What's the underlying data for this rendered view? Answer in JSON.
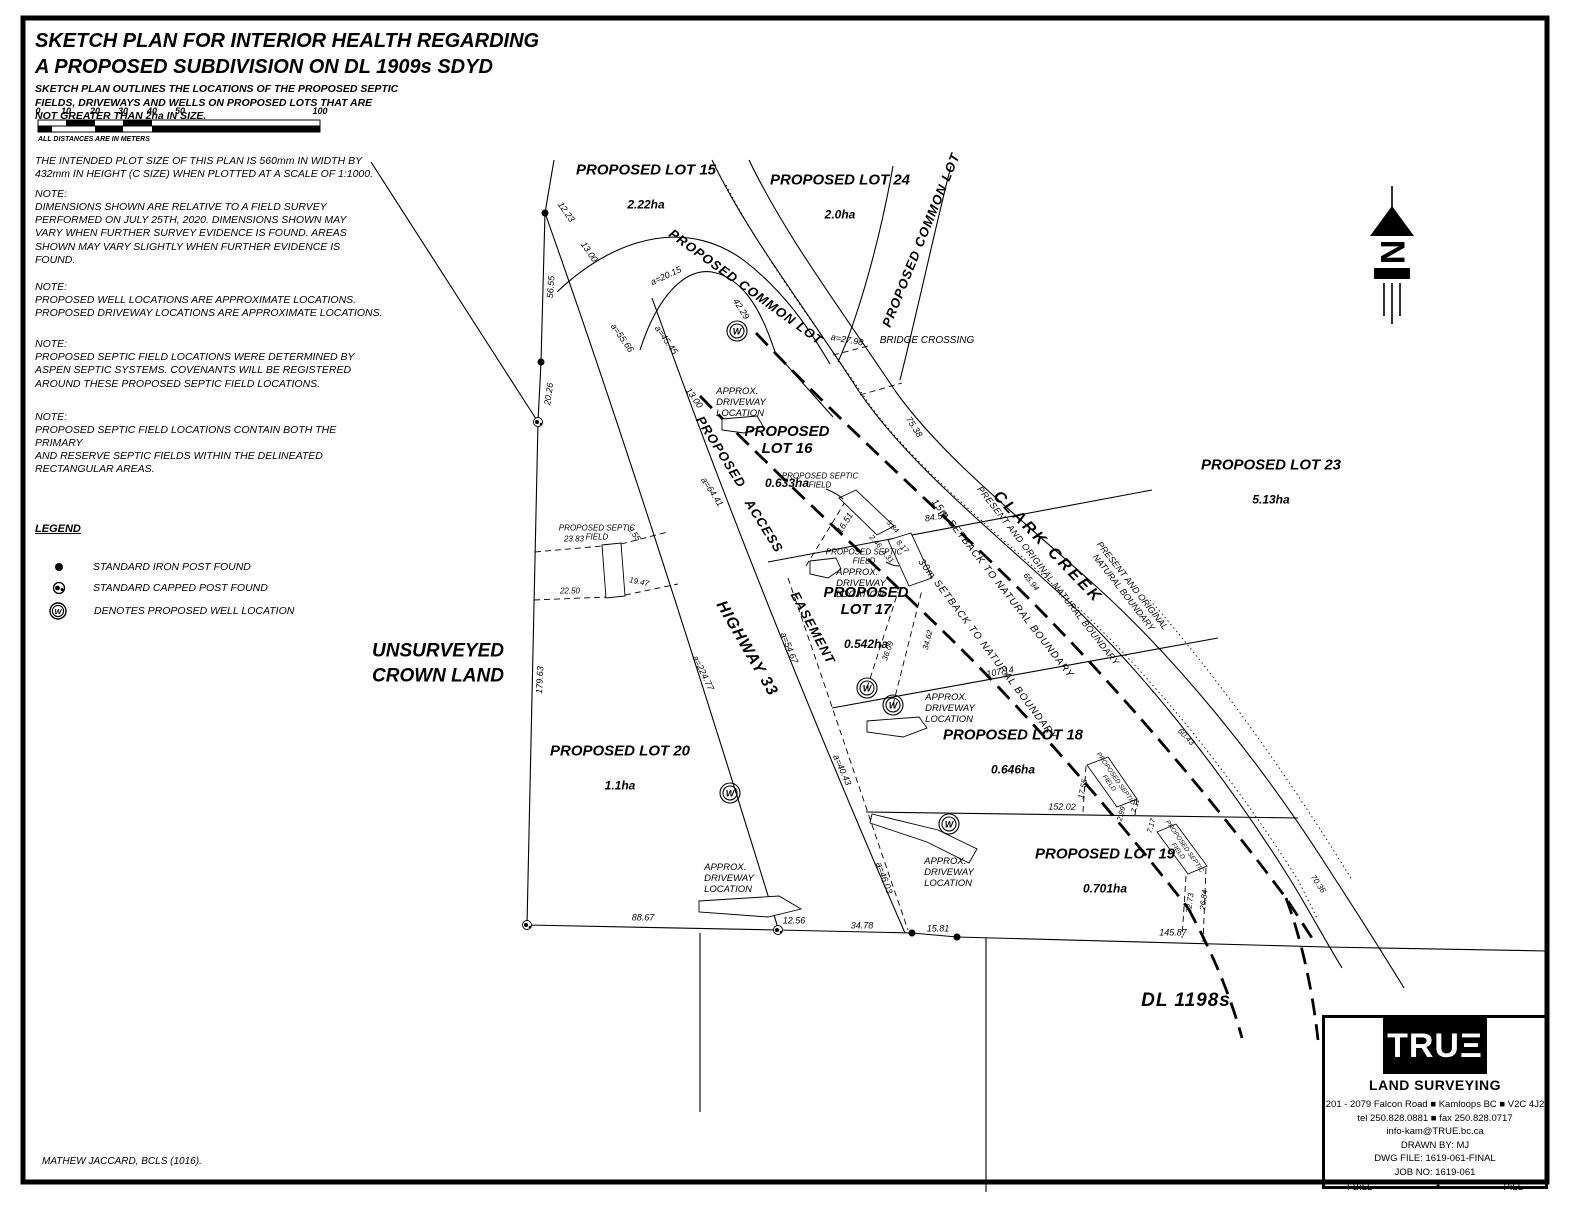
{
  "header": {
    "title1": "SKETCH PLAN FOR INTERIOR HEALTH REGARDING",
    "title2": "A PROPOSED SUBDIVISION ON DL 1909s SDYD",
    "subtitle": "SKETCH PLAN OUTLINES THE LOCATIONS OF THE PROPOSED SEPTIC\nFIELDS, DRIVEWAYS AND WELLS ON PROPOSED LOTS THAT ARE\nNOT GREATER THAN 2ha IN SIZE.",
    "plot_note": "THE INTENDED PLOT SIZE OF THIS PLAN IS 560mm IN WIDTH BY\n432mm IN HEIGHT (C SIZE) WHEN PLOTTED AT A SCALE OF 1:1000."
  },
  "scale_bar": {
    "ticks": [
      "0",
      "10",
      "20",
      "30",
      "40",
      "50",
      "100"
    ],
    "caption": "ALL DISTANCES ARE IN METERS"
  },
  "notes": [
    {
      "heading": "NOTE:",
      "body": "DIMENSIONS SHOWN ARE RELATIVE TO A FIELD SURVEY\nPERFORMED ON JULY 25TH, 2020. DIMENSIONS SHOWN MAY\nVARY WHEN FURTHER SURVEY EVIDENCE IS FOUND. AREAS\nSHOWN MAY VARY SLIGHTLY WHEN FURTHER EVIDENCE IS\nFOUND."
    },
    {
      "heading": "NOTE:",
      "body": "PROPOSED WELL LOCATIONS ARE APPROXIMATE LOCATIONS.\nPROPOSED DRIVEWAY LOCATIONS ARE APPROXIMATE LOCATIONS."
    },
    {
      "heading": "NOTE:",
      "body": "PROPOSED SEPTIC FIELD LOCATIONS WERE DETERMINED BY\nASPEN SEPTIC SYSTEMS. COVENANTS WILL BE REGISTERED\nAROUND THESE PROPOSED SEPTIC FIELD LOCATIONS."
    },
    {
      "heading": "NOTE:",
      "body": "PROPOSED SEPTIC FIELD LOCATIONS CONTAIN BOTH THE PRIMARY\nAND RESERVE SEPTIC FIELDS WITHIN THE DELINEATED\nRECTANGULAR AREAS."
    }
  ],
  "legend": {
    "title": "LEGEND",
    "items": [
      {
        "symbol": "iron-post",
        "label": "STANDARD IRON POST FOUND"
      },
      {
        "symbol": "capped-post",
        "label": "STANDARD CAPPED POST FOUND"
      },
      {
        "symbol": "proposed-well",
        "label": "DENOTES PROPOSED WELL LOCATION"
      }
    ]
  },
  "plan": {
    "well_letter": "W",
    "north_letter": "N",
    "lots": {
      "l15": {
        "n": "PROPOSED LOT 15",
        "a": "2.22ha"
      },
      "l16": {
        "n": "PROPOSED\nLOT 16",
        "a": "0.633ha"
      },
      "l17": {
        "n": "PROPOSED\nLOT 17",
        "a": "0.542ha"
      },
      "l18": {
        "n": "PROPOSED LOT 18",
        "a": "0.646ha"
      },
      "l19": {
        "n": "PROPOSED LOT 19",
        "a": "0.701ha"
      },
      "l20": {
        "n": "PROPOSED LOT 20",
        "a": "1.1ha"
      },
      "l23": {
        "n": "PROPOSED LOT 23",
        "a": "5.13ha"
      },
      "l24": {
        "n": "PROPOSED LOT 24",
        "a": "2.0ha"
      }
    },
    "features": {
      "common_lot": "PROPOSED COMMON LOT",
      "clark_creek": "CLARK CREEK",
      "bridge": "BRIDGE CROSSING",
      "proposed": "PROPOSED",
      "access": "ACCESS",
      "easement": "EASEMENT",
      "highway": "HIGHWAY 33",
      "setback15": "15m SETBACK TO NATURAL BOUNDARY",
      "setback30": "30m SETBACK TO NATURAL BOUNDARY",
      "nat_boundary1": "PRESENT AND ORIGINAL NATURAL BOUNDARY",
      "nat_boundary2": "PRESENT AND ORIGINAL\nNATURAL BOUNDARY",
      "unsurveyed": "UNSURVEYED\nCROWN LAND",
      "dl": "DL  1198s",
      "septic": "PROPOSED SEPTIC\nFIELD",
      "driveway": "APPROX.\nDRIVEWAY\nLOCATION"
    },
    "measurements": [
      "12.23",
      "13.00",
      "56.55",
      "20.26",
      "179.63",
      "a=55.66",
      "a=45.45",
      "a=20.15",
      "13.00",
      "42.29",
      "a=27.98",
      "75.38",
      "a=64.41",
      "84.53",
      "16.51",
      "2.46",
      "4.31",
      "8.17",
      "5.84",
      "107.14",
      "36.09",
      "34.62",
      "a=54.67",
      "a=224.77",
      "a=40.43",
      "a=46.03",
      "152.02",
      "17.55",
      "7.11",
      "2.99",
      "7.17",
      "22.73",
      "26.84",
      "145.87",
      "88.67",
      "12.56",
      "34.78",
      "15.81",
      "23.83",
      "9.55",
      "22.50",
      "19.47",
      "65.94",
      "60.43",
      "70.36"
    ]
  },
  "firm": {
    "logo": "TRUΞ",
    "name": "LAND SURVEYING",
    "address": "201 - 2079 Falcon Road ■ Kamloops BC ■ V2C 4J2",
    "telfax": "tel 250.828.0881 ■ fax 250.828.0717",
    "email": "info-kam@TRUE.bc.ca",
    "drawn": "DRAWN BY: MJ",
    "dwg": "DWG FILE: 1619-061-FINAL",
    "job": "JOB NO: 1619-061",
    "fb": "FB:LL",
    "bullet": "■",
    "p": "P:LL"
  },
  "surveyor": "MATHEW JACCARD, BCLS (1016)."
}
